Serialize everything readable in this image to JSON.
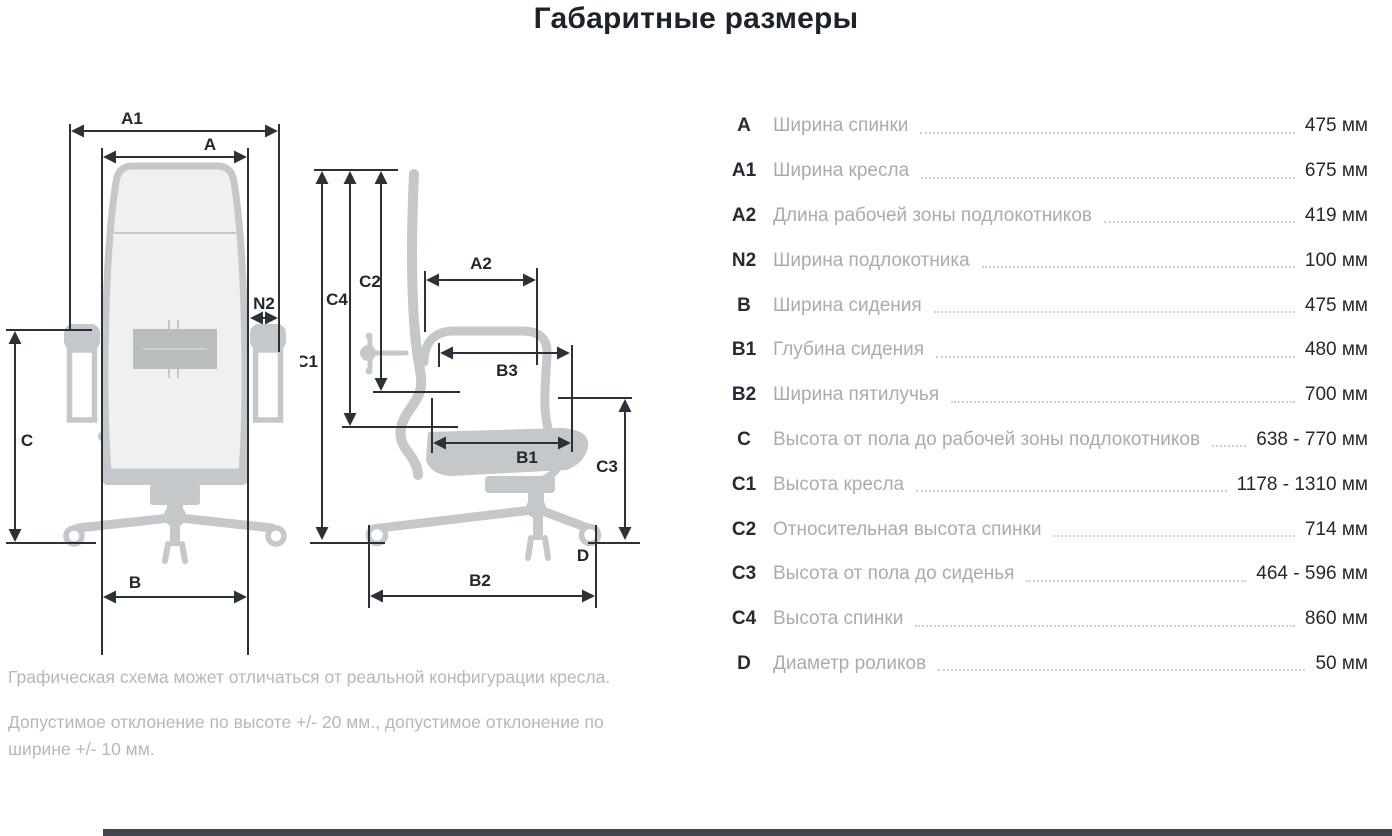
{
  "title": "Габаритные размеры",
  "table": {
    "rows": [
      {
        "code": "A",
        "label": "Ширина спинки",
        "value": "475 мм"
      },
      {
        "code": "A1",
        "label": "Ширина кресла",
        "value": "675 мм"
      },
      {
        "code": "A2",
        "label": "Длина рабочей зоны подлокотников",
        "value": "419 мм"
      },
      {
        "code": "N2",
        "label": "Ширина подлокотника",
        "value": "100 мм"
      },
      {
        "code": "B",
        "label": "Ширина сидения",
        "value": "475 мм"
      },
      {
        "code": "B1",
        "label": "Глубина сидения",
        "value": "480 мм"
      },
      {
        "code": "B2",
        "label": "Ширина пятилучья",
        "value": "700 мм"
      },
      {
        "code": "C",
        "label": "Высота от пола до рабочей зоны подлокотников",
        "value": "638 - 770 мм"
      },
      {
        "code": "C1",
        "label": "Высота кресла",
        "value": "1178 - 1310 мм"
      },
      {
        "code": "C2",
        "label": "Относительная высота спинки",
        "value": "714 мм"
      },
      {
        "code": "C3",
        "label": "Высота от пола до сиденья",
        "value": "464 - 596 мм"
      },
      {
        "code": "C4",
        "label": "Высота спинки",
        "value": "860 мм"
      },
      {
        "code": "D",
        "label": "Диаметр роликов",
        "value": "50 мм"
      }
    ]
  },
  "notes": {
    "line1": "Графическая схема может отличаться от реальной конфигурации кресла.",
    "line2": "Допустимое отклонение по высоте +/- 20 мм., допустимое отклонение по ширине +/- 10 мм."
  },
  "diagram": {
    "front": {
      "a1": "A1",
      "a": "A",
      "n2": "N2",
      "c": "C",
      "b": "B"
    },
    "side": {
      "c1": "C1",
      "c4": "C4",
      "c2": "C2",
      "a2": "A2",
      "b3": "B3",
      "b1": "B1",
      "c3": "C3",
      "d": "D",
      "b2": "B2"
    }
  },
  "colors": {
    "dimension_line": "#2b3138",
    "chair_gray": "#c4c8ca",
    "chair_mesh_fill": "#eef0f1",
    "lumbar_gray": "#b9bdbe",
    "label_gray": "#a7acb3",
    "leader_dots": "#cdd1d5",
    "bottom_bar": "#41464d"
  }
}
